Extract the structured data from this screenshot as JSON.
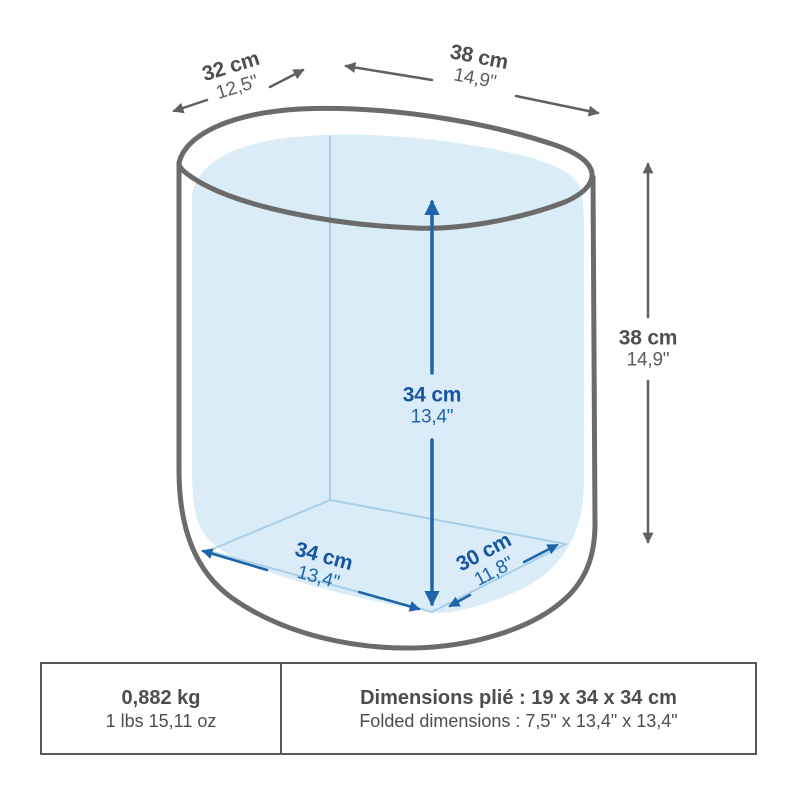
{
  "colors": {
    "outline_gray": "#6b6b6b",
    "arrow_gray": "#606060",
    "accent_blue": "#1e64a9",
    "fill_light_blue": "#d9ecf8",
    "floor_line_blue": "#a9cee9",
    "table_border": "#58585a",
    "text_gray": "#4f4f4f"
  },
  "diagram": {
    "top_depth": {
      "metric": "32 cm",
      "imperial": "12,5\""
    },
    "top_width": {
      "metric": "38 cm",
      "imperial": "14,9\""
    },
    "outer_height": {
      "metric": "38 cm",
      "imperial": "14,9\""
    },
    "inner_height": {
      "metric": "34 cm",
      "imperial": "13,4\""
    },
    "floor_width": {
      "metric": "34 cm",
      "imperial": "13,4\""
    },
    "floor_depth": {
      "metric": "30 cm",
      "imperial": "11,8\""
    }
  },
  "spec_table": {
    "weight": {
      "primary": "0,882 kg",
      "secondary": "1 lbs 15,11 oz"
    },
    "folded": {
      "primary": "Dimensions plié : 19 x 34 x 34 cm",
      "secondary": "Folded dimensions : 7,5\" x 13,4\" x 13,4\""
    }
  }
}
